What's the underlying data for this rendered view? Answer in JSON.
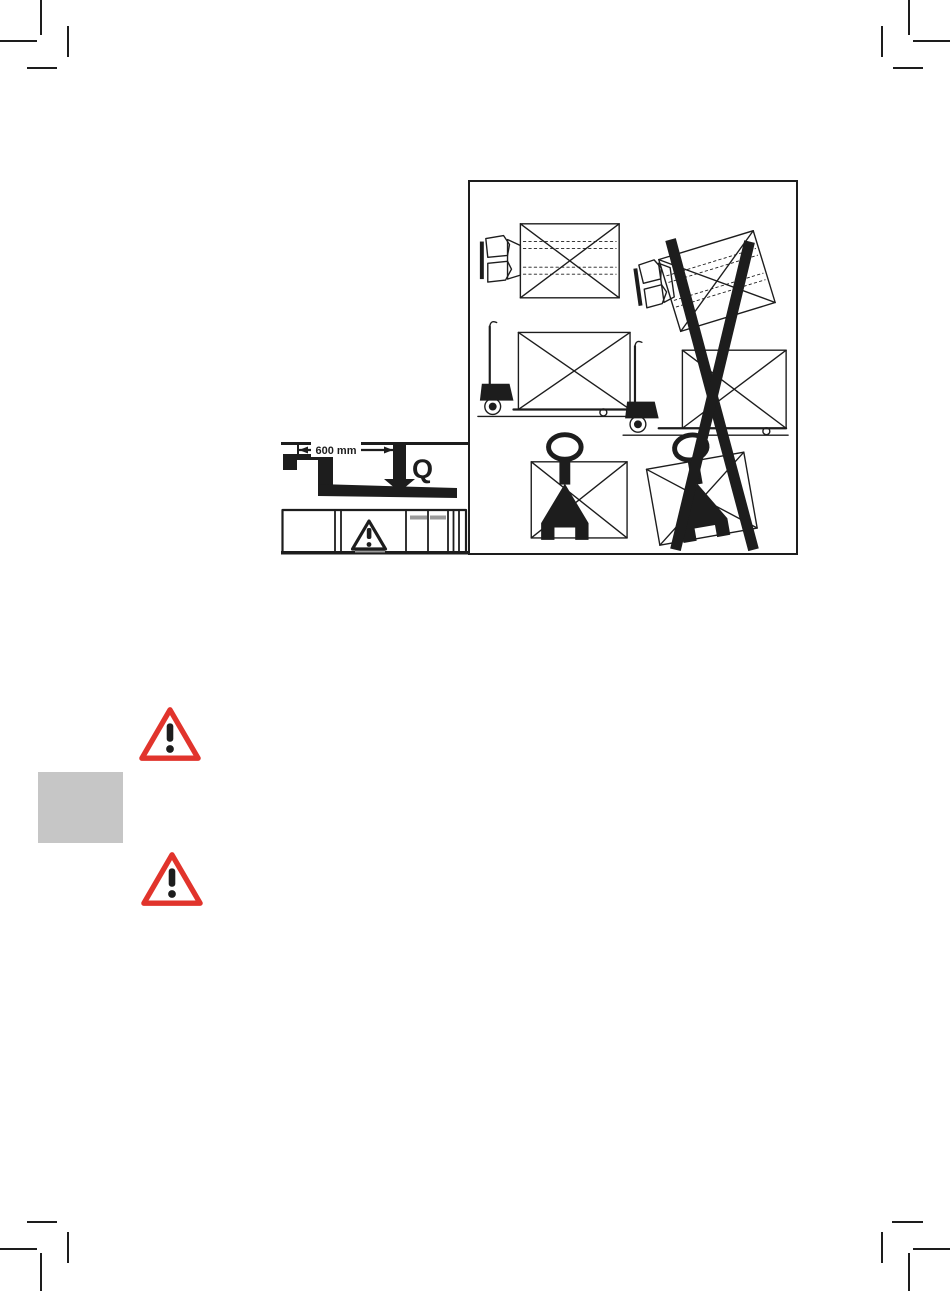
{
  "page": {
    "width": 950,
    "height": 1291,
    "kind": "scanned manual page"
  },
  "colors": {
    "paper": "#ffffff",
    "ink": "#1d1d1d",
    "warning_red": "#e1342c",
    "tab_gray": "#c6c6c6",
    "plate_gray": "#9b9b9b"
  },
  "load_center_diagram": {
    "dimension_label": "600 mm",
    "load_symbol": "Q",
    "plate_symbol": "exclamation-triangle-icon"
  },
  "usage_illustration": {
    "theme": "correct vs incorrect load placement on hand pallet truck",
    "panels": [
      {
        "view": "top",
        "column": "left",
        "status": "correct"
      },
      {
        "view": "top",
        "column": "right",
        "status": "incorrect"
      },
      {
        "view": "side",
        "column": "left",
        "status": "correct"
      },
      {
        "view": "side",
        "column": "right",
        "status": "incorrect"
      },
      {
        "view": "front",
        "column": "left",
        "status": "correct"
      },
      {
        "view": "front",
        "column": "right",
        "status": "incorrect"
      }
    ],
    "crossout": "large black X over incorrect right column"
  },
  "warning_icons": [
    {
      "name": "exclamation-triangle-icon"
    },
    {
      "name": "exclamation-triangle-icon"
    }
  ],
  "print_marks": {
    "corner_crop_marks": 4
  }
}
